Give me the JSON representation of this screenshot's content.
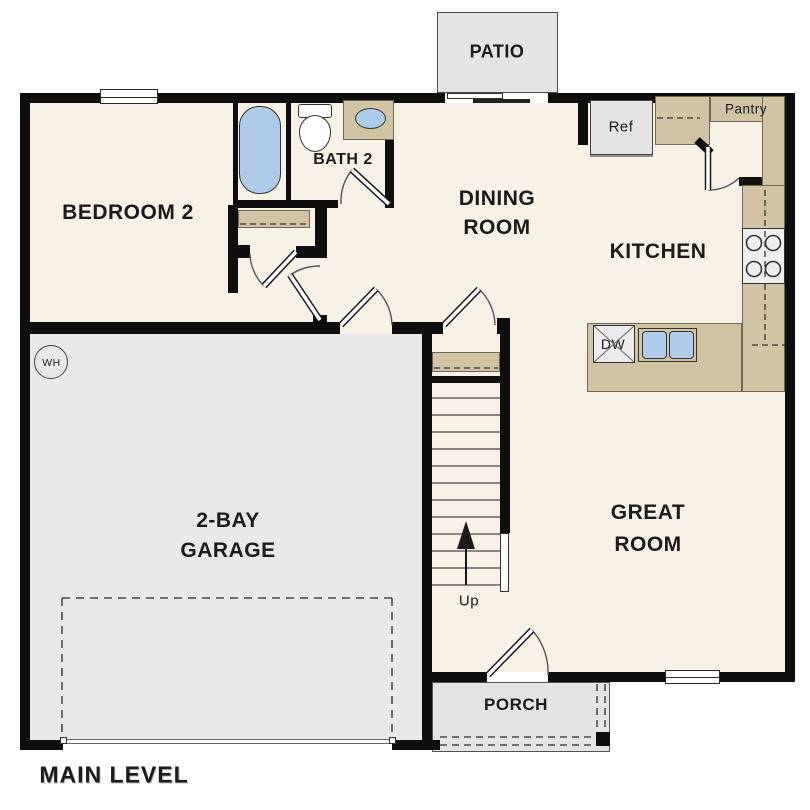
{
  "title": "MAIN LEVEL",
  "labels": {
    "patio": "PATIO",
    "bedroom2": "BEDROOM 2",
    "bath2": "BATH 2",
    "dining_line1": "DINING",
    "dining_line2": "ROOM",
    "kitchen": "KITCHEN",
    "ref": "Ref",
    "pantry": "Pantry",
    "dw": "DW",
    "great_line1": "GREAT",
    "great_line2": "ROOM",
    "garage_line1": "2-BAY",
    "garage_line2": "GARAGE",
    "up": "Up",
    "porch": "PORCH",
    "wh": "WH",
    "main_level": "MAIN LEVEL"
  },
  "colors": {
    "floor": "#f8f1e6",
    "garage": "#e9e9e9",
    "outdoor": "#e4e4e4",
    "counter": "#d2c3a5",
    "fixture_blue": "#aecbea",
    "wall": "#0e0e0e"
  }
}
